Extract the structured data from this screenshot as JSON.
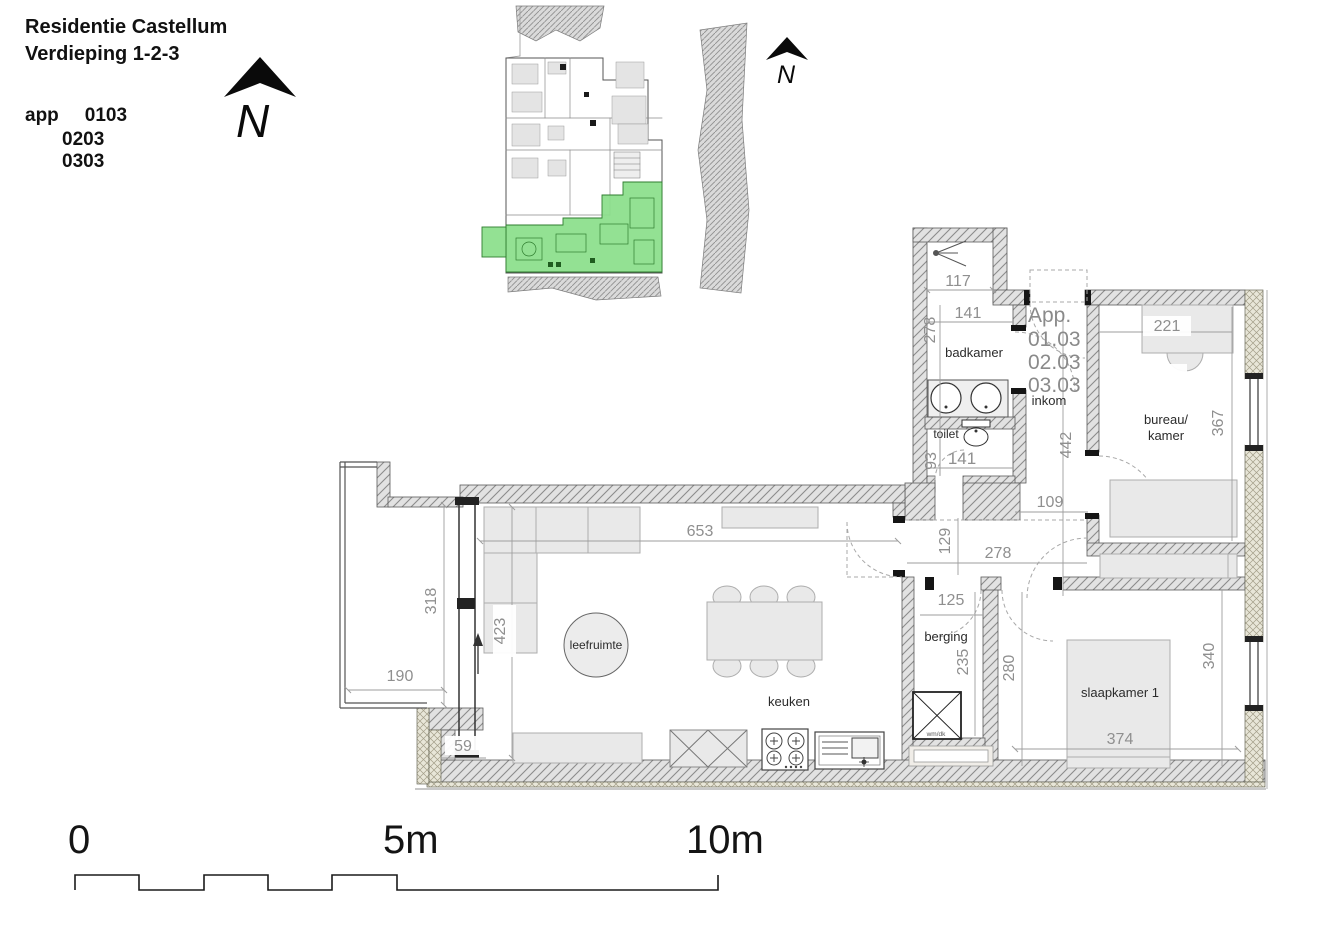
{
  "header": {
    "title": "Residentie Castellum",
    "subtitle": "Verdieping 1-2-3",
    "app_label": "app",
    "apartments": [
      "0103",
      "0203",
      "0303"
    ]
  },
  "north": {
    "label": "N"
  },
  "apartment_ref": {
    "prefix": "App.",
    "list": [
      "01.03",
      "02.03",
      "03.03"
    ]
  },
  "rooms": {
    "badkamer": "badkamer",
    "toilet": "toilet",
    "inkom": "inkom",
    "bureau_line1": "bureau/",
    "bureau_line2": "kamer",
    "leefruimte": "leefruimte",
    "keuken": "keuken",
    "berging": "berging",
    "slaapkamer": "slaapkamer 1",
    "washer": "wm/dk"
  },
  "dims": {
    "shower_width": "117",
    "bath_height": "278",
    "bath_width": "141",
    "toilet_height": "93",
    "toilet_width": "141",
    "inkom_height": "442",
    "desk_width": "221",
    "bureau_height": "367",
    "hall_width": "109",
    "hall_height": "129",
    "hall_width2": "278",
    "living_width": "653",
    "sofa_height": "423",
    "terrace_height": "318",
    "terrace_width": "190",
    "corner": "59",
    "berging_width": "125",
    "berging_height": "235",
    "passage_height": "280",
    "bedroom_height": "340",
    "bedroom_width": "374"
  },
  "scalebar": {
    "zero": "0",
    "five": "5m",
    "ten": "10m"
  },
  "colors": {
    "highlight_green": "#8ade8a",
    "wall_gray": "#e2e2e2",
    "dim_gray": "#8f8f8f"
  }
}
